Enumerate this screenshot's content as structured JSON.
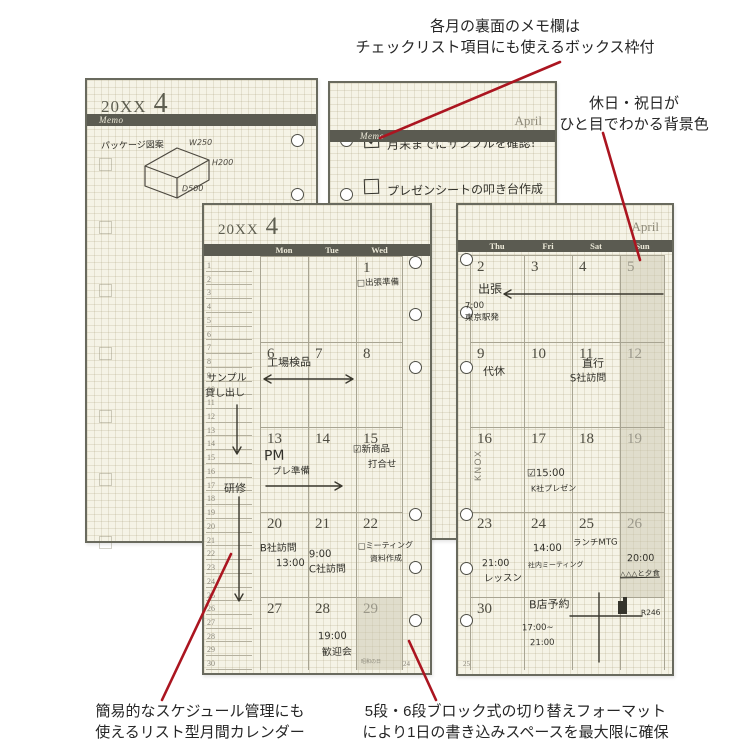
{
  "annotations": {
    "memo_feature": [
      "各月の裏面のメモ欄は",
      "チェックリスト項目にも使えるボックス枠付"
    ],
    "holiday_feature": [
      "休日・祝日が",
      "ひと目でわかる背景色"
    ],
    "list_feature": [
      "簡易的なスケジュール管理にも",
      "使えるリスト型月間カレンダー"
    ],
    "block_feature": [
      "5段・6段ブロック式の切り替えフォーマット",
      "により1日の書き込みスペースを最大限に確保"
    ]
  },
  "colors": {
    "page_bg": "#f5f3e6",
    "header_bar": "#5b5b51",
    "holiday_bg": "#e4e1d2",
    "annotation_line_red": "#ab1520",
    "handwriting": "#32312a"
  },
  "memo_left": {
    "year": "20XX",
    "month": "4",
    "section": "Memo",
    "sketch_caption": "パッケージ図案",
    "sketch_dims": {
      "w": "W250",
      "h": "H200",
      "d": "D500"
    }
  },
  "memo_right": {
    "month": "April",
    "section": "Memo",
    "checklist": [
      {
        "checked": true,
        "text": "月末までにサンプルを確認!"
      },
      {
        "checked": false,
        "text": "プレゼンシートの叩き台作成"
      }
    ]
  },
  "cal_left": {
    "year": "20XX",
    "month": "4",
    "days": [
      "Mon",
      "Tue",
      "Wed"
    ],
    "list_numbers": [
      1,
      2,
      3,
      4,
      5,
      6,
      7,
      8,
      9,
      10,
      11,
      12,
      13,
      14,
      15,
      16,
      17,
      18,
      19,
      20,
      21,
      22,
      23,
      24,
      25,
      26,
      27,
      28,
      29,
      30
    ],
    "weeks": [
      [
        "",
        "",
        "1"
      ],
      [
        "6",
        "7",
        "8"
      ],
      [
        "13",
        "14",
        "15"
      ],
      [
        "20",
        "21",
        "22"
      ],
      [
        "27",
        "28",
        "29"
      ]
    ],
    "page_no": "24",
    "notes": {
      "trip_prep": "□出張準備",
      "inspection": "工場検品",
      "sample1": "サンプル",
      "sample2": "貸し出し",
      "training": "研修",
      "pm": "PM",
      "prep": "プレ準備",
      "newprod": "☑新商品",
      "newprod2": "打合せ",
      "b_visit": "B社訪問",
      "b_time": "13:00",
      "c_time": "9:00",
      "c_visit": "C社訪問",
      "mtg": "□ミーティング",
      "mtg2": "資料作成",
      "welcome_time": "19:00",
      "welcome": "歓迎会",
      "holiday_label": "昭和の日"
    }
  },
  "cal_right": {
    "month": "April",
    "days": [
      "Thu",
      "Fri",
      "Sat",
      "Sun"
    ],
    "brand": "KNOX",
    "weeks": [
      [
        "2",
        "3",
        "4",
        "5"
      ],
      [
        "9",
        "10",
        "11",
        "12"
      ],
      [
        "16",
        "17",
        "18",
        "19"
      ],
      [
        "23",
        "24",
        "25",
        "26"
      ],
      [
        "30",
        "",
        "",
        ""
      ]
    ],
    "page_no": "25",
    "notes": {
      "trip": "出張",
      "dep_time": "7:00",
      "dep": "東京駅発",
      "daikyu": "代休",
      "chokko": "直行",
      "s_visit": "S社訪問",
      "k_time": "☑15:00",
      "k_pres": "K社プレゼン",
      "lesson_time": "21:00",
      "lesson": "レッスン",
      "mtg_time": "14:00",
      "mtg": "社内ミーティング",
      "lunch": "ランチMTG",
      "dinner_time": "20:00",
      "dinner": "△△△と夕食",
      "b_reserve": "B店予約",
      "b_from": "17:00~",
      "b_to": "21:00",
      "route": "R246"
    }
  }
}
